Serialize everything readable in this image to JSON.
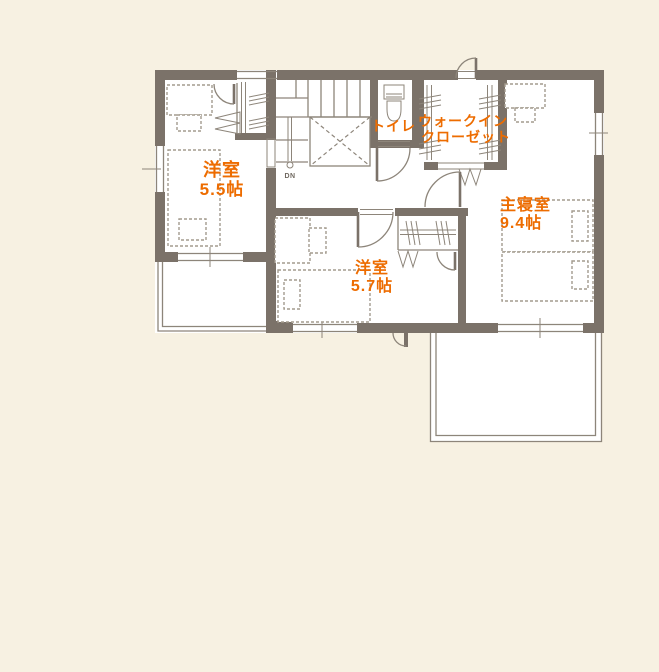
{
  "palette": {
    "background": "#f7f1e2",
    "room_fill": "#ffffff",
    "wall": "#7b7269",
    "line": "#8d857a",
    "furniture_line": "#a39b8e",
    "accent_text": "#ed6c00",
    "stair_text": "#6f685f"
  },
  "floor_plan": {
    "rooms": [
      {
        "id": "western-room-5-5",
        "name": "洋室",
        "size": "5.5帖"
      },
      {
        "id": "western-room-5-7",
        "name": "洋室",
        "size": "5.7帖"
      },
      {
        "id": "master-bedroom",
        "name": "主寝室",
        "size": "9.4帖"
      },
      {
        "id": "toilet",
        "name": "トイレ"
      },
      {
        "id": "walk-in-closet",
        "name_line1": "ウォークイン",
        "name_line2": "クローゼット"
      }
    ],
    "stairs": {
      "direction_label": "DN"
    }
  }
}
